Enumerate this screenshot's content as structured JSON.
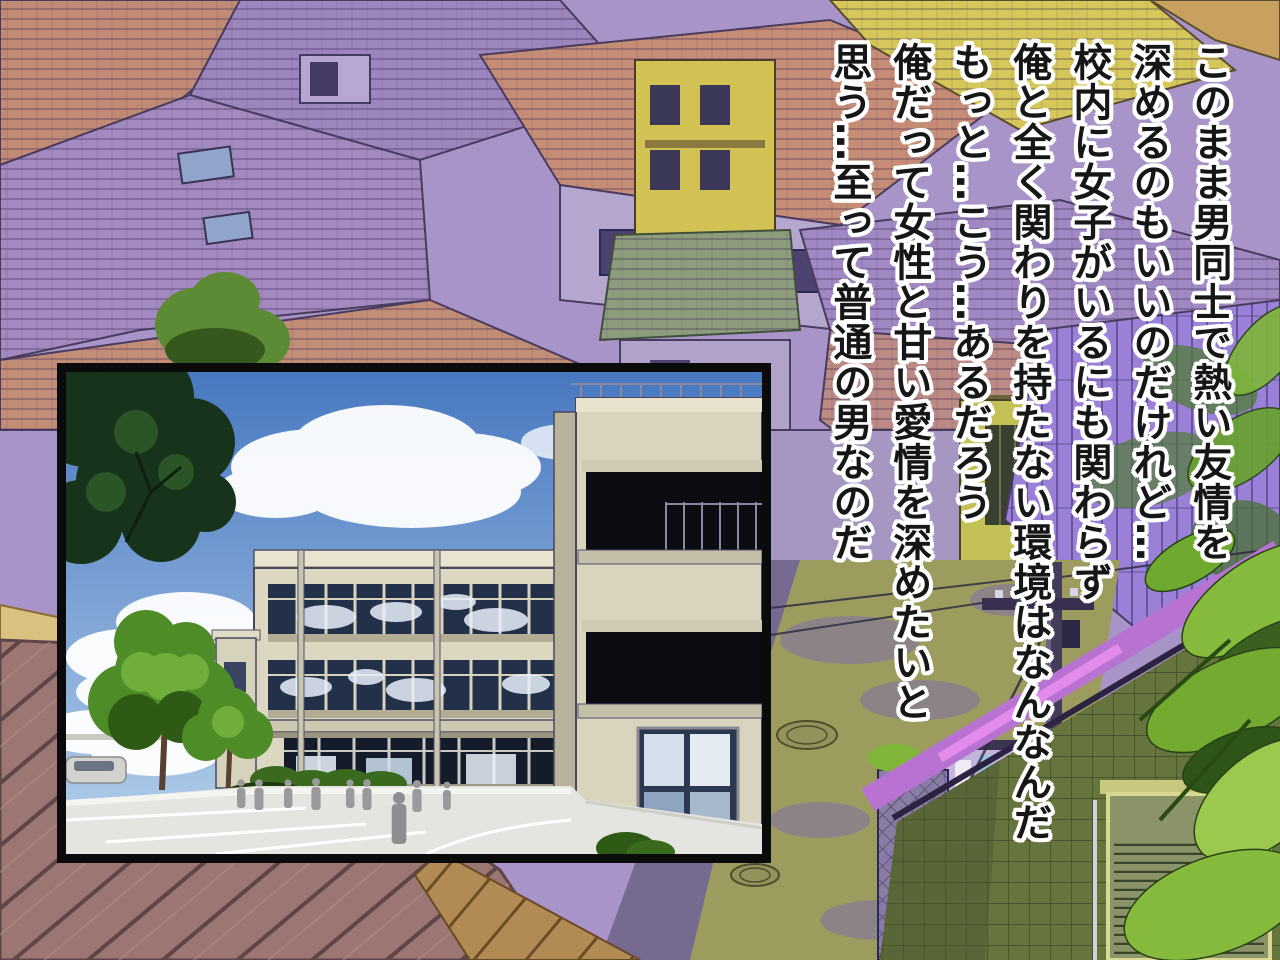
{
  "narration": {
    "lines": [
      "このまま男同士で熱い友情を",
      "深めるのもいいのだけれど…",
      "校内に女子がいるにも関わらず",
      "俺と全く関わりを持たない環境はなんなんだ",
      "もっと…こう…あるだろう",
      "俺だって女性と甘い愛情を深めたいと",
      "思う…至って普通の男なのだ"
    ]
  },
  "inset_panel": {
    "image": "school-building-front-entrance"
  },
  "colors": {
    "text": "#161616",
    "text_outline": "#ffffff",
    "panel_border": "#0b0b0b",
    "sky_top": "#4878c0",
    "sky_bottom": "#b6d2ec",
    "roof_salmon": "#c68d76",
    "roof_violet": "#9a80d6",
    "roof_yellow": "#d5c75a",
    "roof_brown": "#9b7672",
    "wall_lavender": "#b4a6ce",
    "wall_green": "#66743e",
    "road_olive": "#9c9c5e",
    "foliage_green": "#86ba3c"
  }
}
